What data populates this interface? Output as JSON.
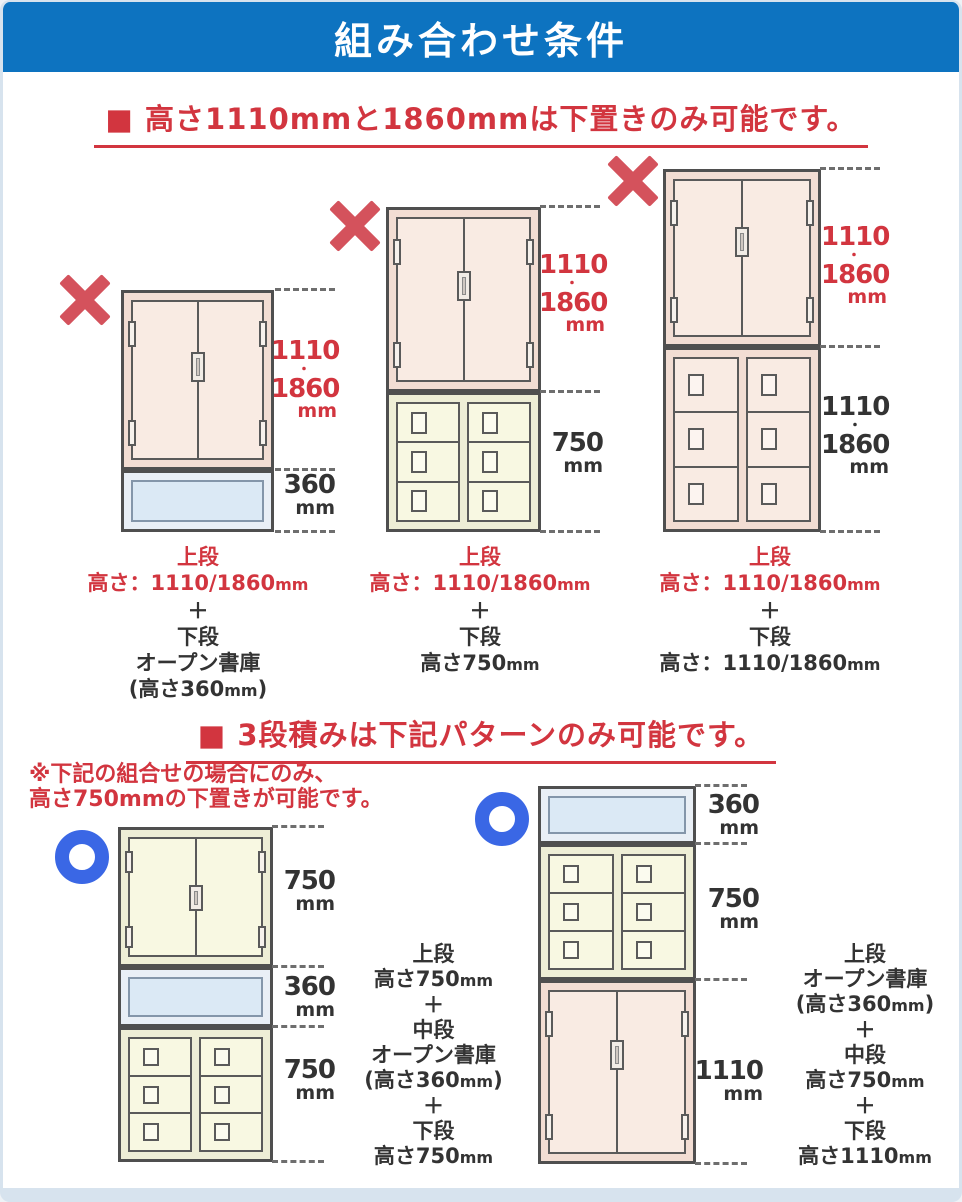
{
  "header": {
    "title": "組み合わせ条件"
  },
  "colors": {
    "header_bg": "#0d73c0",
    "red_text": "#d2353f",
    "x_mark_red": "#d4525c",
    "ok_circle_blue": "#3a67e5",
    "pink_cabinet": "#f9ebe3",
    "cream_cabinet": "#f8f8e2",
    "open_shelf_blue": "#dbe9f5"
  },
  "icons": {
    "ng": "x-mark-icon",
    "ok": "circle-ok-icon"
  },
  "section1": {
    "heading": "■ 高さ1110mmと1860mmは下置きのみ可能です。",
    "dim_tall": {
      "a": "1110",
      "dot": "・",
      "b": "1860",
      "u": "mm"
    },
    "dim_360": {
      "a": "360",
      "u": "mm"
    },
    "dim_750": {
      "a": "750",
      "u": "mm"
    },
    "cap1": {
      "l1": "上段",
      "l2a": "高さ：1110/1860",
      "l2u": "mm",
      "l3": "＋",
      "l4": "下段",
      "l5": "オープン書庫",
      "l6a": "(高さ360",
      "l6u": "mm",
      "l6c": ")"
    },
    "cap2": {
      "l1": "上段",
      "l2a": "高さ：1110/1860",
      "l2u": "mm",
      "l3": "＋",
      "l4": "下段",
      "l5a": "高さ750",
      "l5u": "mm"
    },
    "cap3": {
      "l1": "上段",
      "l2a": "高さ：1110/1860",
      "l2u": "mm",
      "l3": "＋",
      "l4": "下段",
      "l5a": "高さ：1110/1860",
      "l5u": "mm"
    }
  },
  "section2": {
    "heading": "■ 3段積みは下記パターンのみ可能です。",
    "note_line1": "※下記の組合せの場合にのみ、",
    "note_line2": "高さ750mmの下置きが可能です。",
    "dim_750": {
      "a": "750",
      "u": "mm"
    },
    "dim_360": {
      "a": "360",
      "u": "mm"
    },
    "dim_1110": {
      "a": "1110",
      "u": "mm"
    },
    "cap4": {
      "l1": "上段",
      "l2a": "高さ750",
      "l2u": "mm",
      "l3": "＋",
      "l4": "中段",
      "l5": "オープン書庫",
      "l6a": "(高さ360",
      "l6u": "mm",
      "l6c": ")",
      "l7": "＋",
      "l8": "下段",
      "l9a": "高さ750",
      "l9u": "mm"
    },
    "cap5": {
      "l1": "上段",
      "l2": "オープン書庫",
      "l3a": "(高さ360",
      "l3u": "mm",
      "l3c": ")",
      "l4": "＋",
      "l5": "中段",
      "l6a": "高さ750",
      "l6u": "mm",
      "l7": "＋",
      "l8": "下段",
      "l9a": "高さ1110",
      "l9u": "mm"
    }
  }
}
